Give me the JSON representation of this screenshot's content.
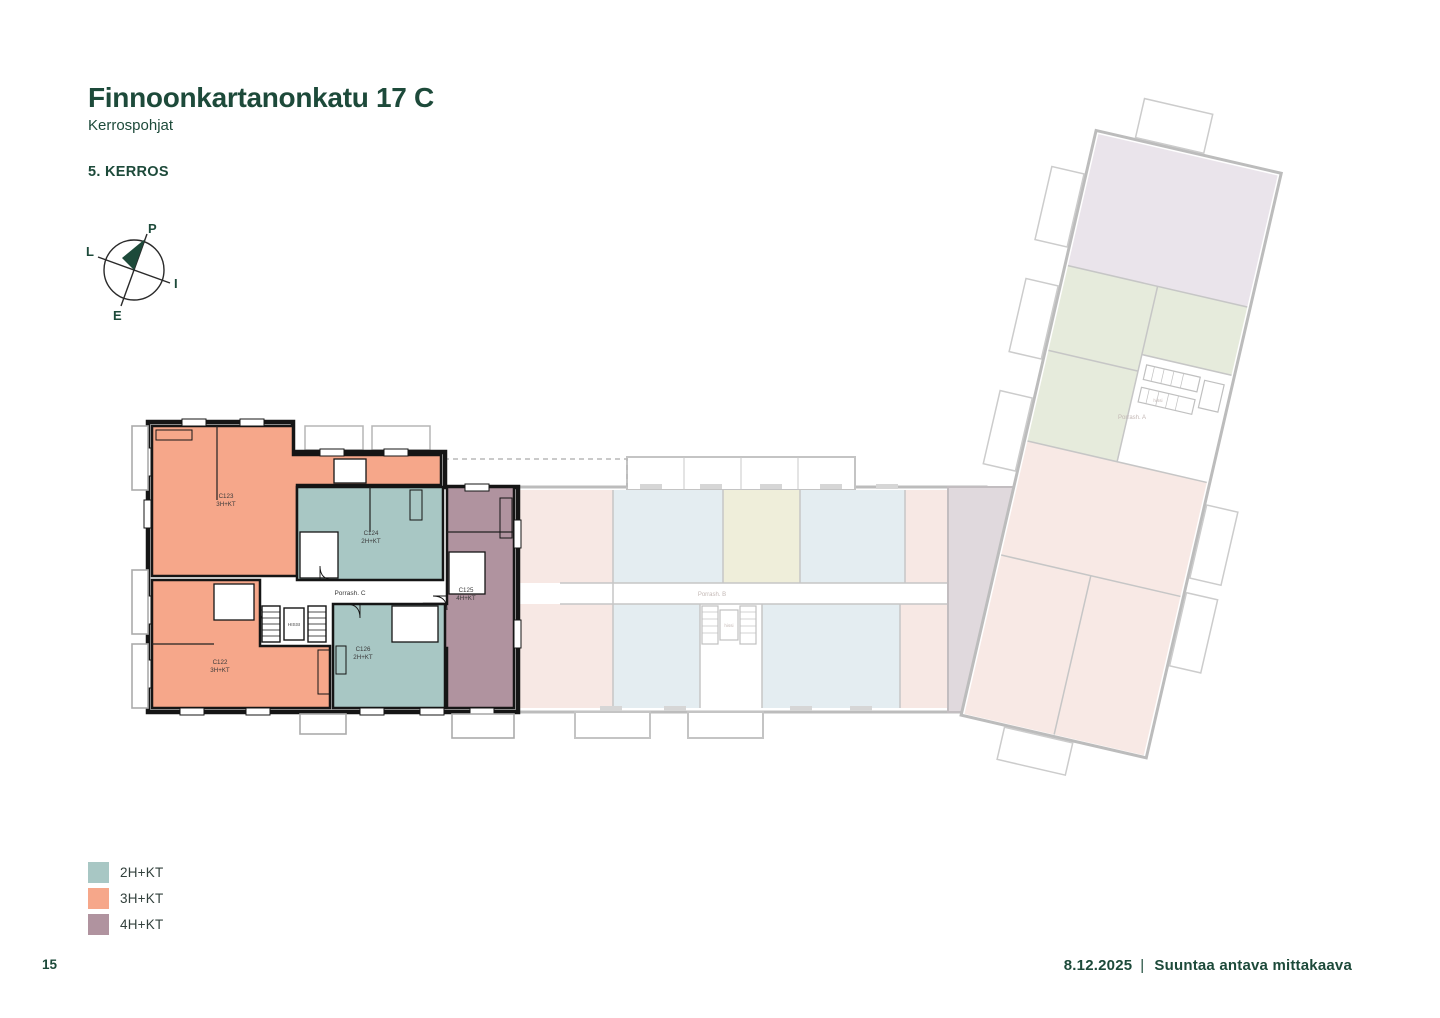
{
  "page": {
    "accent_color": "#1D4A3A",
    "background": "#ffffff"
  },
  "header": {
    "title": "Finnoonkartanonkatu 17 C",
    "subtitle": "Kerrospohjat",
    "floor_label": "5. KERROS"
  },
  "compass": {
    "north_label": "P",
    "east_label": "I",
    "south_label": "E",
    "west_label": "L"
  },
  "floor_plan": {
    "stairwell_c_label": "Porrash. C",
    "elevator_c_label": "HISSI",
    "stairwell_b_label": "Porrash. B",
    "elevator_b_label": "hissi",
    "stairwell_a_label": "Porrash. A",
    "elevator_a_label": "hissi",
    "apartments": [
      {
        "id": "C123",
        "type": "3H+KT",
        "color": "#F6A78A"
      },
      {
        "id": "C124",
        "type": "2H+KT",
        "color": "#A8C7C4"
      },
      {
        "id": "C125",
        "type": "4H+KT",
        "color": "#B0939F"
      },
      {
        "id": "C122",
        "type": "3H+KT",
        "color": "#F6A78A"
      },
      {
        "id": "C126",
        "type": "2H+KT",
        "color": "#A8C7C4"
      }
    ]
  },
  "legend": {
    "items": [
      {
        "label": "2H+KT",
        "color": "#A8C7C4"
      },
      {
        "label": "3H+KT",
        "color": "#F6A78A"
      },
      {
        "label": "4H+KT",
        "color": "#B0939F"
      }
    ]
  },
  "footer": {
    "page_number": "15",
    "date": "8.12.2025",
    "separator": "|",
    "note": "Suuntaa antava mittakaava"
  }
}
